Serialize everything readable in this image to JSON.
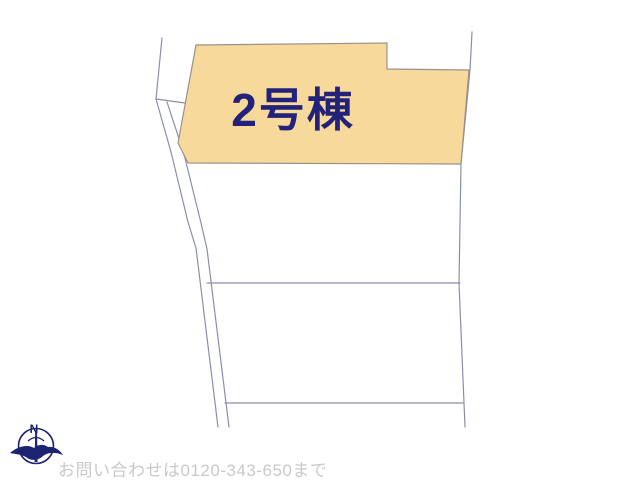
{
  "map": {
    "highlighted_lot": {
      "label": "2号棟",
      "fill_color": "#f6d99b",
      "outline_color": "#9a918c",
      "label_color": "#22227a"
    },
    "boundary_line_color": "#8a8fa9"
  },
  "compass": {
    "icon": "compass-north-icon",
    "north_label": "N",
    "color": "#1c2370"
  },
  "footer": {
    "contact_text": "お問い合わせは0120-343-650まで",
    "text_color": "#c9c9c9"
  }
}
